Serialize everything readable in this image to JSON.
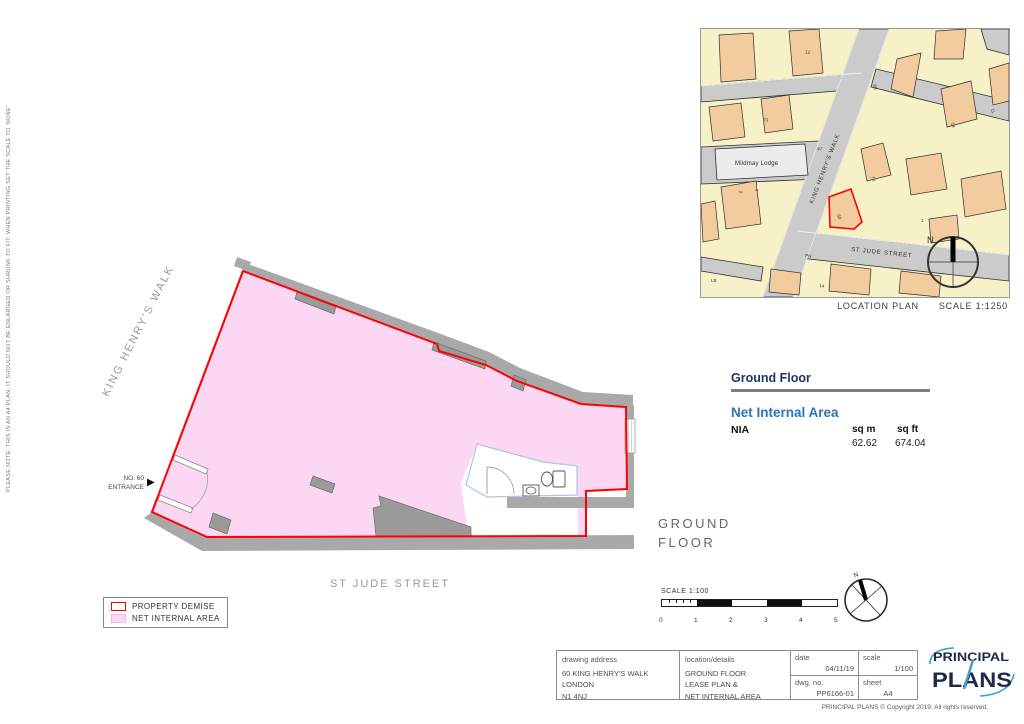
{
  "colors": {
    "nia_pink": "#FBD7F3",
    "demise_red": "#FF0000",
    "wall_gray": "#A9A9A9",
    "wall_dark": "#9A9A9A",
    "map_street": "#CBCBCB",
    "map_yellow": "#F6F1C6",
    "map_orange": "#F2CC9E",
    "map_line": "#2F2F2F",
    "bath_blue": "#A9C7E7",
    "heading_navy": "#17375E",
    "heading_blue": "#2E74B5",
    "logo_navy": "#1E2B45",
    "logo_blue": "#3E9ED6"
  },
  "side_note": "PLEASE NOTE: THIS IS AN A4 PLAN, IT SHOULD NOT BE ENLARGED OR SHRUNK TO FIT. WHEN PRINTING SET THE SCALE TO 'NONE'",
  "location_plan": {
    "caption": "LOCATION PLAN",
    "scale_label": "SCALE 1:1250",
    "street_khw": "KING HENRY'S WALK",
    "street_stjude": "ST JUDE STREET",
    "lodge": "Mildmay Lodge",
    "north": "N",
    "numbers": [
      "12",
      "68",
      "73",
      "47",
      "19",
      "11",
      "70",
      "60",
      "1",
      "2",
      "4",
      "PH",
      "14",
      "LB"
    ]
  },
  "area_schedule": {
    "title": "Ground Floor",
    "subtitle": "Net Internal Area",
    "row_label": "NIA",
    "col_sqm": "sq m",
    "col_sqft": "sq ft",
    "sqm_value": "62.62",
    "sqft_value": "674.04"
  },
  "floor_plan": {
    "street_left": "KING HENRY'S WALK",
    "street_bottom": "ST JUDE STREET",
    "entrance_line1": "NO. 60",
    "entrance_line2": "ENTRANCE",
    "floor_line1": "GROUND",
    "floor_line2": "FLOOR"
  },
  "legend": {
    "items": [
      {
        "label": "PROPERTY DEMISE"
      },
      {
        "label": "NET INTERNAL AREA"
      }
    ]
  },
  "scale_bar": {
    "label": "SCALE 1:100",
    "ticks": [
      "0",
      "1",
      "2",
      "3",
      "4",
      "5"
    ]
  },
  "north": "N",
  "title_block": {
    "address_label": "drawing address",
    "address_lines": [
      "60 KING HENRY'S WALK",
      "LONDON",
      "N1 4NJ"
    ],
    "details_label": "location/details",
    "details_lines": [
      "GROUND FLOOR",
      "LEASE PLAN &",
      "NET INTERNAL AREA"
    ],
    "date_label": "date",
    "date_value": "04/11/19",
    "scale_label": "scale",
    "scale_value": "1/100",
    "dwg_label": "dwg. no.",
    "dwg_value": "PP6166-01",
    "sheet_label": "sheet",
    "sheet_value": "A4"
  },
  "footer": {
    "copyright": "PRINCIPAL PLANS © Copyright 2019. All rights reserved."
  },
  "logo": {
    "line1": "PRINCIPAL",
    "line2": "PLANS"
  }
}
